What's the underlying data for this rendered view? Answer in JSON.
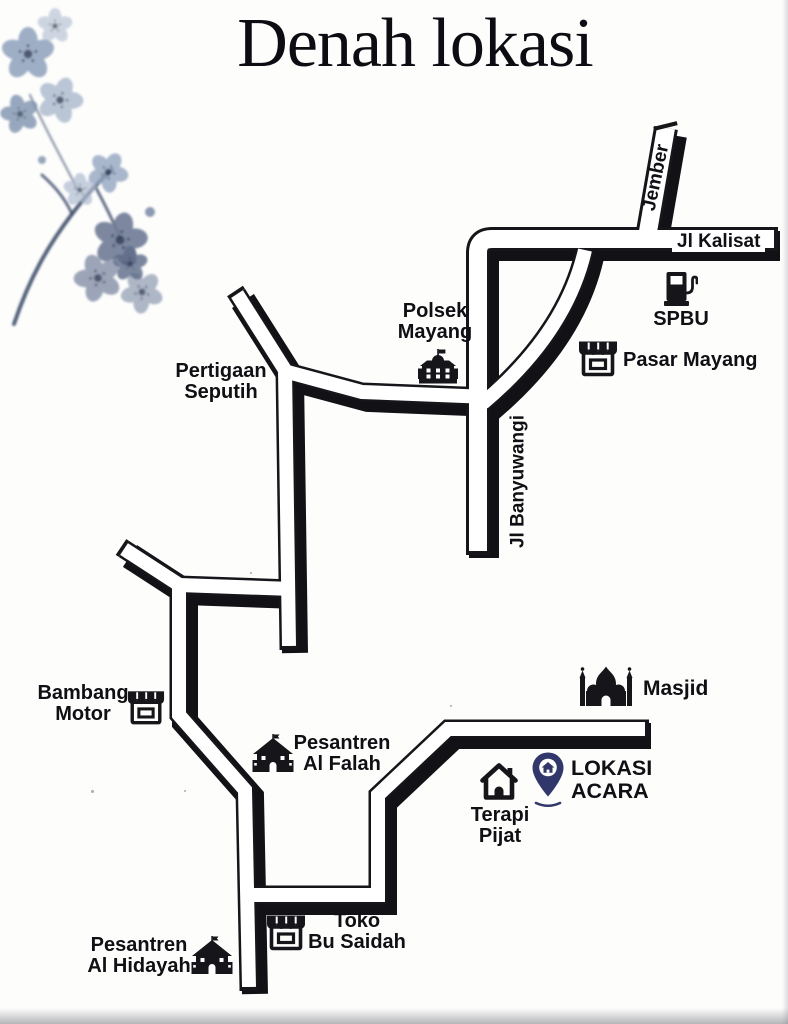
{
  "title": "Denah lokasi",
  "roads": {
    "jember": {
      "label": "Jember"
    },
    "kalisat": {
      "label": "Jl Kalisat"
    },
    "banyuwangi": {
      "label": "Jl Banyuwangi"
    }
  },
  "landmarks": {
    "polsek_mayang": {
      "line1": "Polsek",
      "line2": "Mayang",
      "icon": "police-building-icon"
    },
    "spbu": {
      "label": "SPBU",
      "icon": "gas-pump-icon"
    },
    "pasar_mayang": {
      "label": "Pasar Mayang",
      "icon": "storefront-icon"
    },
    "pertigaan_seputih": {
      "line1": "Pertigaan",
      "line2": "Seputih"
    },
    "bambang_motor": {
      "line1": "Bambang",
      "line2": "Motor",
      "icon": "storefront-icon"
    },
    "pesantren_al_falah": {
      "line1": "Pesantren",
      "line2": "Al Falah",
      "icon": "school-house-icon"
    },
    "masjid": {
      "label": "Masjid",
      "icon": "mosque-icon"
    },
    "terapi_pijat": {
      "line1": "Terapi",
      "line2": "Pijat",
      "icon": "home-outline-icon"
    },
    "lokasi_acara": {
      "line1": "LOKASI",
      "line2": "ACARA",
      "icon": "location-pin-icon"
    },
    "toko_bu_saidah": {
      "line1": "Toko",
      "line2": "Bu Saidah",
      "icon": "storefront-icon"
    },
    "pesantren_al_hidayah": {
      "line1": "Pesantren",
      "line2": "Al Hidayah",
      "icon": "school-house-icon"
    }
  },
  "colors": {
    "ink": "#15151a",
    "road_fill": "#ffffff",
    "pin": "#31376a"
  }
}
